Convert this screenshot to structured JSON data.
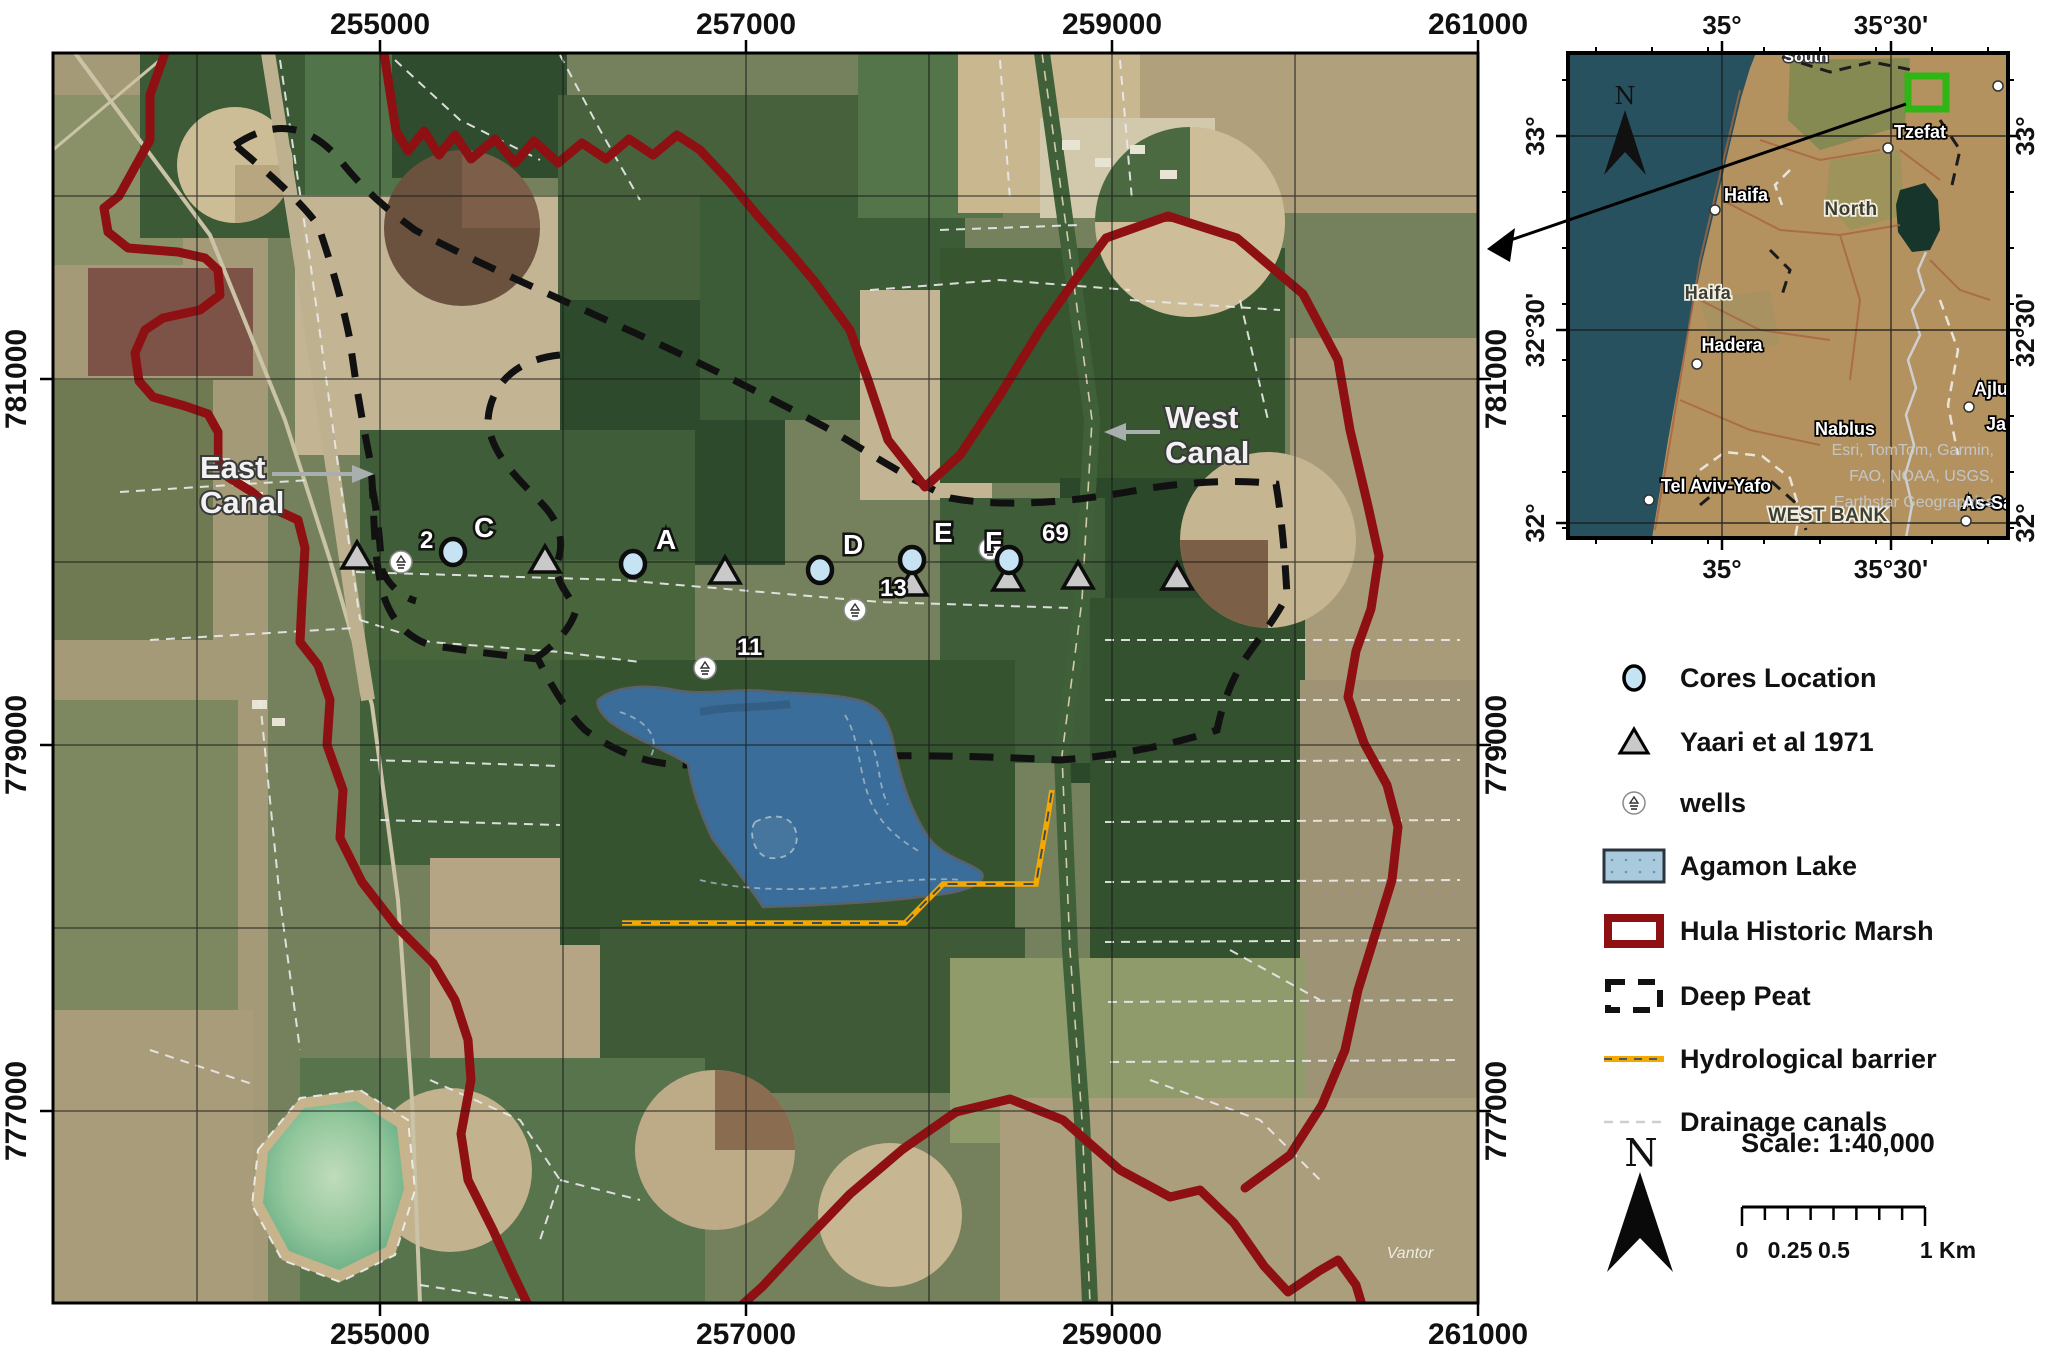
{
  "main_map": {
    "x_ticks": [
      {
        "label": "255000",
        "x": 380
      },
      {
        "label": "257000",
        "x": 746
      },
      {
        "label": "259000",
        "x": 1112
      },
      {
        "label": "261000",
        "x": 1478
      }
    ],
    "y_ticks": [
      {
        "label": "781000",
        "y": 379
      },
      {
        "label": "779000",
        "y": 745
      },
      {
        "label": "777000",
        "y": 1111
      }
    ],
    "annotations": {
      "east_canal_1": "East",
      "east_canal_2": "Canal",
      "west_canal_1": "West",
      "west_canal_2": "Canal",
      "watermark": "Vantor"
    },
    "cores": [
      {
        "label": "C",
        "x": 453,
        "y": 552,
        "lx": 474,
        "ly": 537
      },
      {
        "label": "A",
        "x": 633,
        "y": 564,
        "lx": 656,
        "ly": 549
      },
      {
        "label": "D",
        "x": 820,
        "y": 570,
        "lx": 843,
        "ly": 554
      },
      {
        "label": "E",
        "x": 912,
        "y": 560,
        "lx": 934,
        "ly": 542
      },
      {
        "label": "F",
        "x": 1009,
        "y": 560,
        "lx": 985,
        "ly": 551
      }
    ],
    "triangles": [
      [
        357,
        556
      ],
      [
        545,
        560
      ],
      [
        725,
        571
      ],
      [
        912,
        583
      ],
      [
        1008,
        578
      ],
      [
        1078,
        576
      ],
      [
        1177,
        577
      ]
    ],
    "wells": [
      {
        "label": "2",
        "x": 401,
        "y": 562,
        "lx": 420,
        "ly": 548
      },
      {
        "label": "13",
        "x": 855,
        "y": 610,
        "lx": 880,
        "ly": 596
      },
      {
        "label": "11",
        "x": 705,
        "y": 668,
        "lx": 737,
        "ly": 655
      },
      {
        "label": "69",
        "x": 990,
        "y": 549,
        "lx": 1042,
        "ly": 541
      }
    ]
  },
  "inset": {
    "x_ticks": [
      {
        "label": "35°",
        "x": 1722
      },
      {
        "label": "35°30'",
        "x": 1891
      }
    ],
    "y_ticks": [
      {
        "label": "33°",
        "y": 136
      },
      {
        "label": "32°30'",
        "y": 330
      },
      {
        "label": "32°",
        "y": 523
      }
    ],
    "cities": [
      {
        "name": "Tzefat",
        "x": 1920,
        "y": 138,
        "a": "m"
      },
      {
        "name": "Haifa",
        "x": 1746,
        "y": 201,
        "a": "m"
      },
      {
        "name": "Hadera",
        "x": 1732,
        "y": 351,
        "a": "m"
      },
      {
        "name": "Tel Aviv-Yafo",
        "x": 1716,
        "y": 492,
        "a": "m"
      },
      {
        "name": "Nablus",
        "x": 1845,
        "y": 435,
        "a": "m"
      },
      {
        "name": "Ajlun",
        "x": 1974,
        "y": 395,
        "a": "s"
      },
      {
        "name": "Jarash",
        "x": 1986,
        "y": 430,
        "a": "s"
      },
      {
        "name": "As-Salt",
        "x": 1962,
        "y": 509,
        "a": "s"
      }
    ],
    "dots": [
      [
        1888,
        148
      ],
      [
        1715,
        210
      ],
      [
        1697,
        364
      ],
      [
        1649,
        500
      ],
      [
        1969,
        407
      ],
      [
        1966,
        521
      ],
      [
        1998,
        86
      ]
    ],
    "regions": [
      {
        "name": "North",
        "x": 1851,
        "y": 215,
        "s": 19
      },
      {
        "name": "Haifa",
        "x": 1708,
        "y": 299,
        "s": 18
      },
      {
        "name": "WEST BANK",
        "x": 1828,
        "y": 521,
        "s": 19
      }
    ],
    "edge_label": "South",
    "attribution": [
      "Esri, TomTom, Garmin,",
      "FAO, NOAA, USGS,",
      "Earthstar Geographics"
    ],
    "north_letter": "N"
  },
  "legend": {
    "items": [
      {
        "type": "core",
        "label": "Cores Location"
      },
      {
        "type": "triangle",
        "label": "Yaari et al 1971"
      },
      {
        "type": "well",
        "label": "wells"
      },
      {
        "type": "lake",
        "label": "Agamon Lake"
      },
      {
        "type": "marsh",
        "label": "Hula Historic Marsh"
      },
      {
        "type": "peat",
        "label": "Deep Peat"
      },
      {
        "type": "barrier",
        "label": "Hydrological barrier"
      },
      {
        "type": "drainage",
        "label": "Drainage canals"
      }
    ]
  },
  "scalebar": {
    "title": "Scale: 1:40,000",
    "labels": [
      {
        "t": "0",
        "x": 1742
      },
      {
        "t": "0.25",
        "x": 1790
      },
      {
        "t": "0.5",
        "x": 1834
      },
      {
        "t": "1 Km",
        "x": 1948
      }
    ]
  },
  "north_letter": "N",
  "colors": {
    "marsh": "#8e1012",
    "peat": "#111111",
    "barrier": "#f5a800",
    "lake": "#3a6d99",
    "core_fill": "#c5e3f2",
    "triangle_fill": "#c9c9c9",
    "drainage": "#e9e9e9",
    "sea": "#27515f"
  }
}
